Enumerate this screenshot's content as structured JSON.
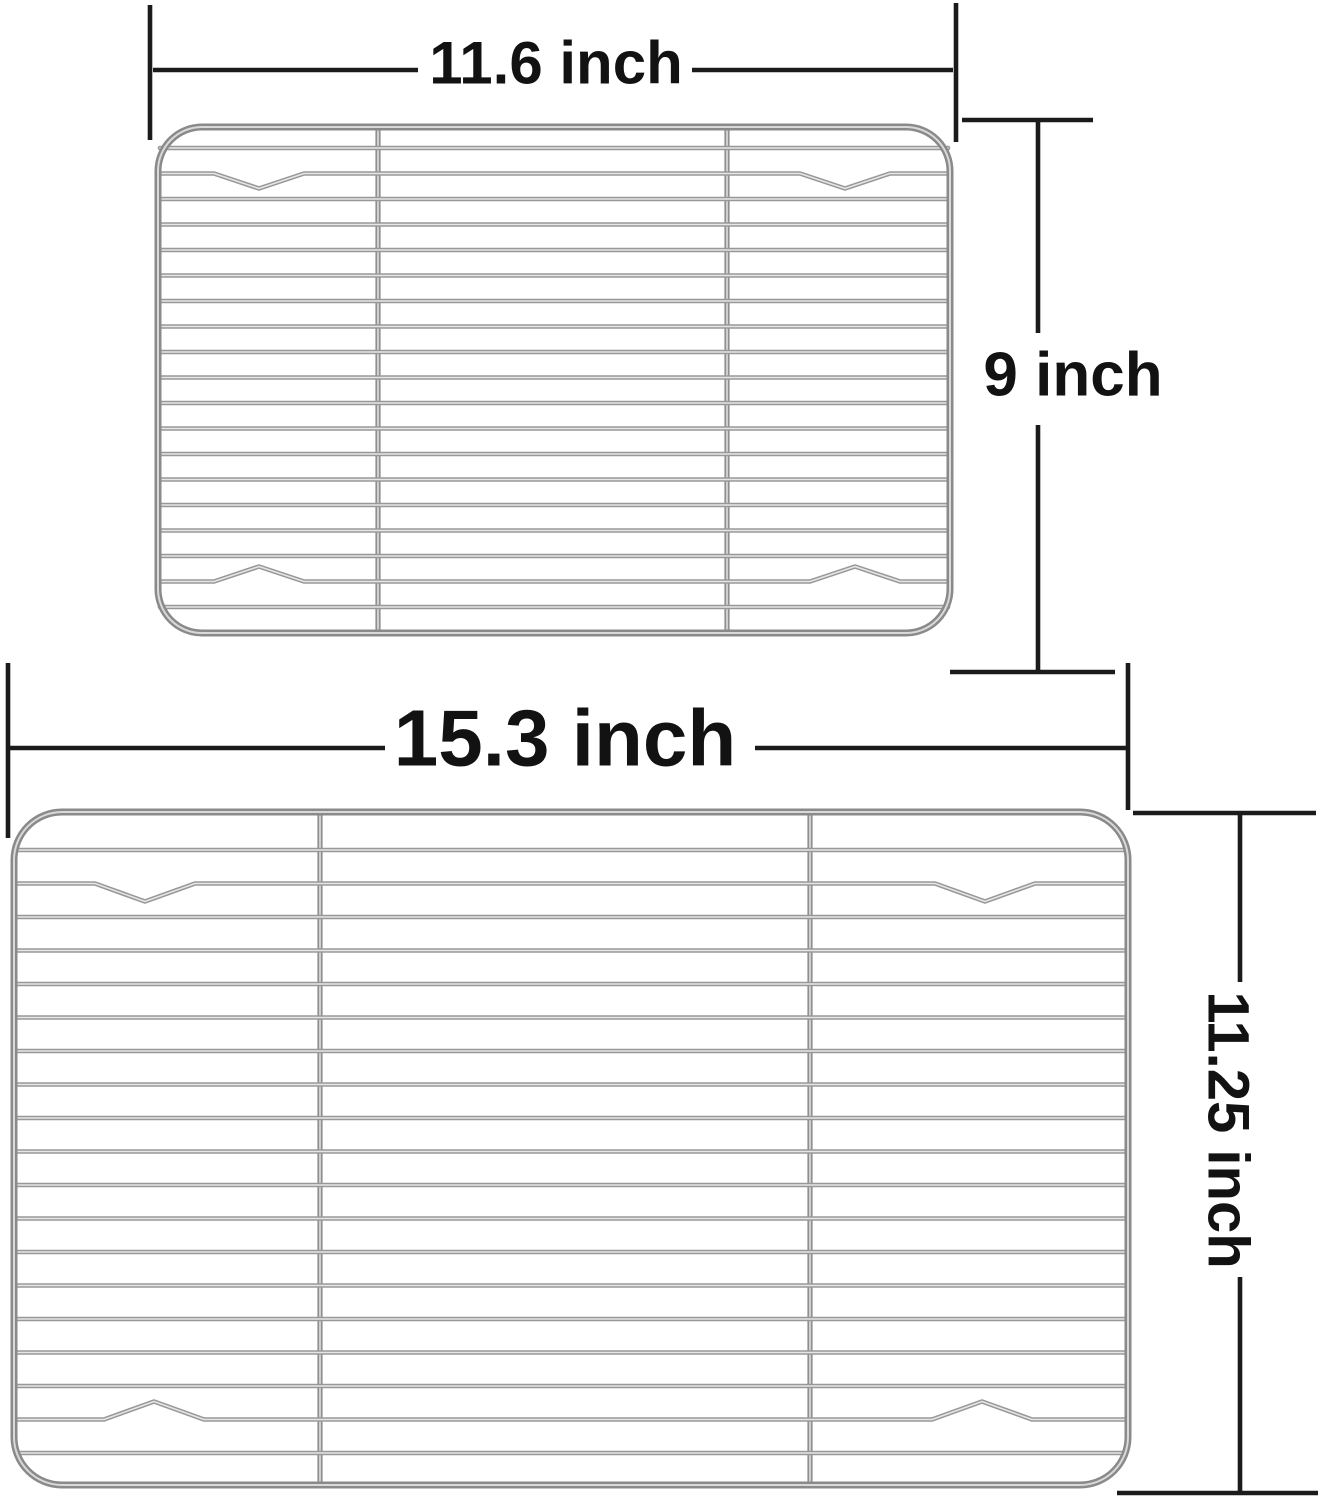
{
  "image": {
    "description": "Size comparison of two stainless steel wire cooling racks with dimension callouts",
    "background": "#ffffff"
  },
  "colors": {
    "annotation_line": "#1b1b1b",
    "label_text": "#121212",
    "wire_dark": "#989898",
    "wire_light": "#e6e6e6",
    "bar_dark": "#8f8f8f",
    "bar_light": "#dfdfdf",
    "frame_dark": "#8a8a8a",
    "frame_light": "#d9d9d9"
  },
  "racks": [
    {
      "id": "small-rack",
      "frame": {
        "x": 158,
        "y": 127,
        "w": 792,
        "h": 506,
        "r": 44
      },
      "bars_x": [
        378,
        727
      ],
      "wires": {
        "count": 19,
        "first_y": 148,
        "spacing": 25.5
      },
      "notch_half": 45,
      "notch_depth": 15,
      "notches": [
        {
          "wire_index": 1,
          "direction": "down",
          "centers_x": [
            259,
            845
          ]
        },
        {
          "wire_index": 17,
          "direction": "up",
          "centers_x": [
            259,
            855
          ]
        }
      ]
    },
    {
      "id": "large-rack",
      "frame": {
        "x": 14,
        "y": 812,
        "w": 1114,
        "h": 673,
        "r": 48
      },
      "bars_x": [
        320,
        810
      ],
      "wires": {
        "count": 19,
        "first_y": 850,
        "spacing": 33.5
      },
      "notch_half": 50,
      "notch_depth": 18,
      "notches": [
        {
          "wire_index": 1,
          "direction": "down",
          "centers_x": [
            145,
            985
          ]
        },
        {
          "wire_index": 17,
          "direction": "up",
          "centers_x": [
            154,
            982
          ]
        }
      ]
    }
  ],
  "annotations": {
    "small_width": {
      "label": "11.6 inch",
      "lines": [
        [
          150,
          5,
          150,
          140
        ],
        [
          956,
          3,
          956,
          142
        ],
        [
          153,
          70,
          418,
          70
        ],
        [
          692,
          70,
          953,
          70
        ]
      ]
    },
    "small_height": {
      "label": "9 inch",
      "lines": [
        [
          962,
          120,
          1093,
          120
        ],
        [
          1038,
          122,
          1038,
          333
        ],
        [
          1038,
          425,
          1038,
          670
        ],
        [
          950,
          672,
          1115,
          672
        ]
      ]
    },
    "large_width": {
      "label": "15.3 inch",
      "lines": [
        [
          8,
          663,
          8,
          838
        ],
        [
          1128,
          663,
          1128,
          810
        ],
        [
          10,
          748,
          385,
          748
        ],
        [
          755,
          748,
          1126,
          748
        ]
      ]
    },
    "large_height": {
      "label": "11.25 inch",
      "lines": [
        [
          1133,
          813,
          1316,
          813
        ],
        [
          1240,
          815,
          1240,
          982
        ],
        [
          1240,
          1277,
          1240,
          1491
        ],
        [
          1117,
          1493,
          1318,
          1493
        ]
      ]
    }
  }
}
